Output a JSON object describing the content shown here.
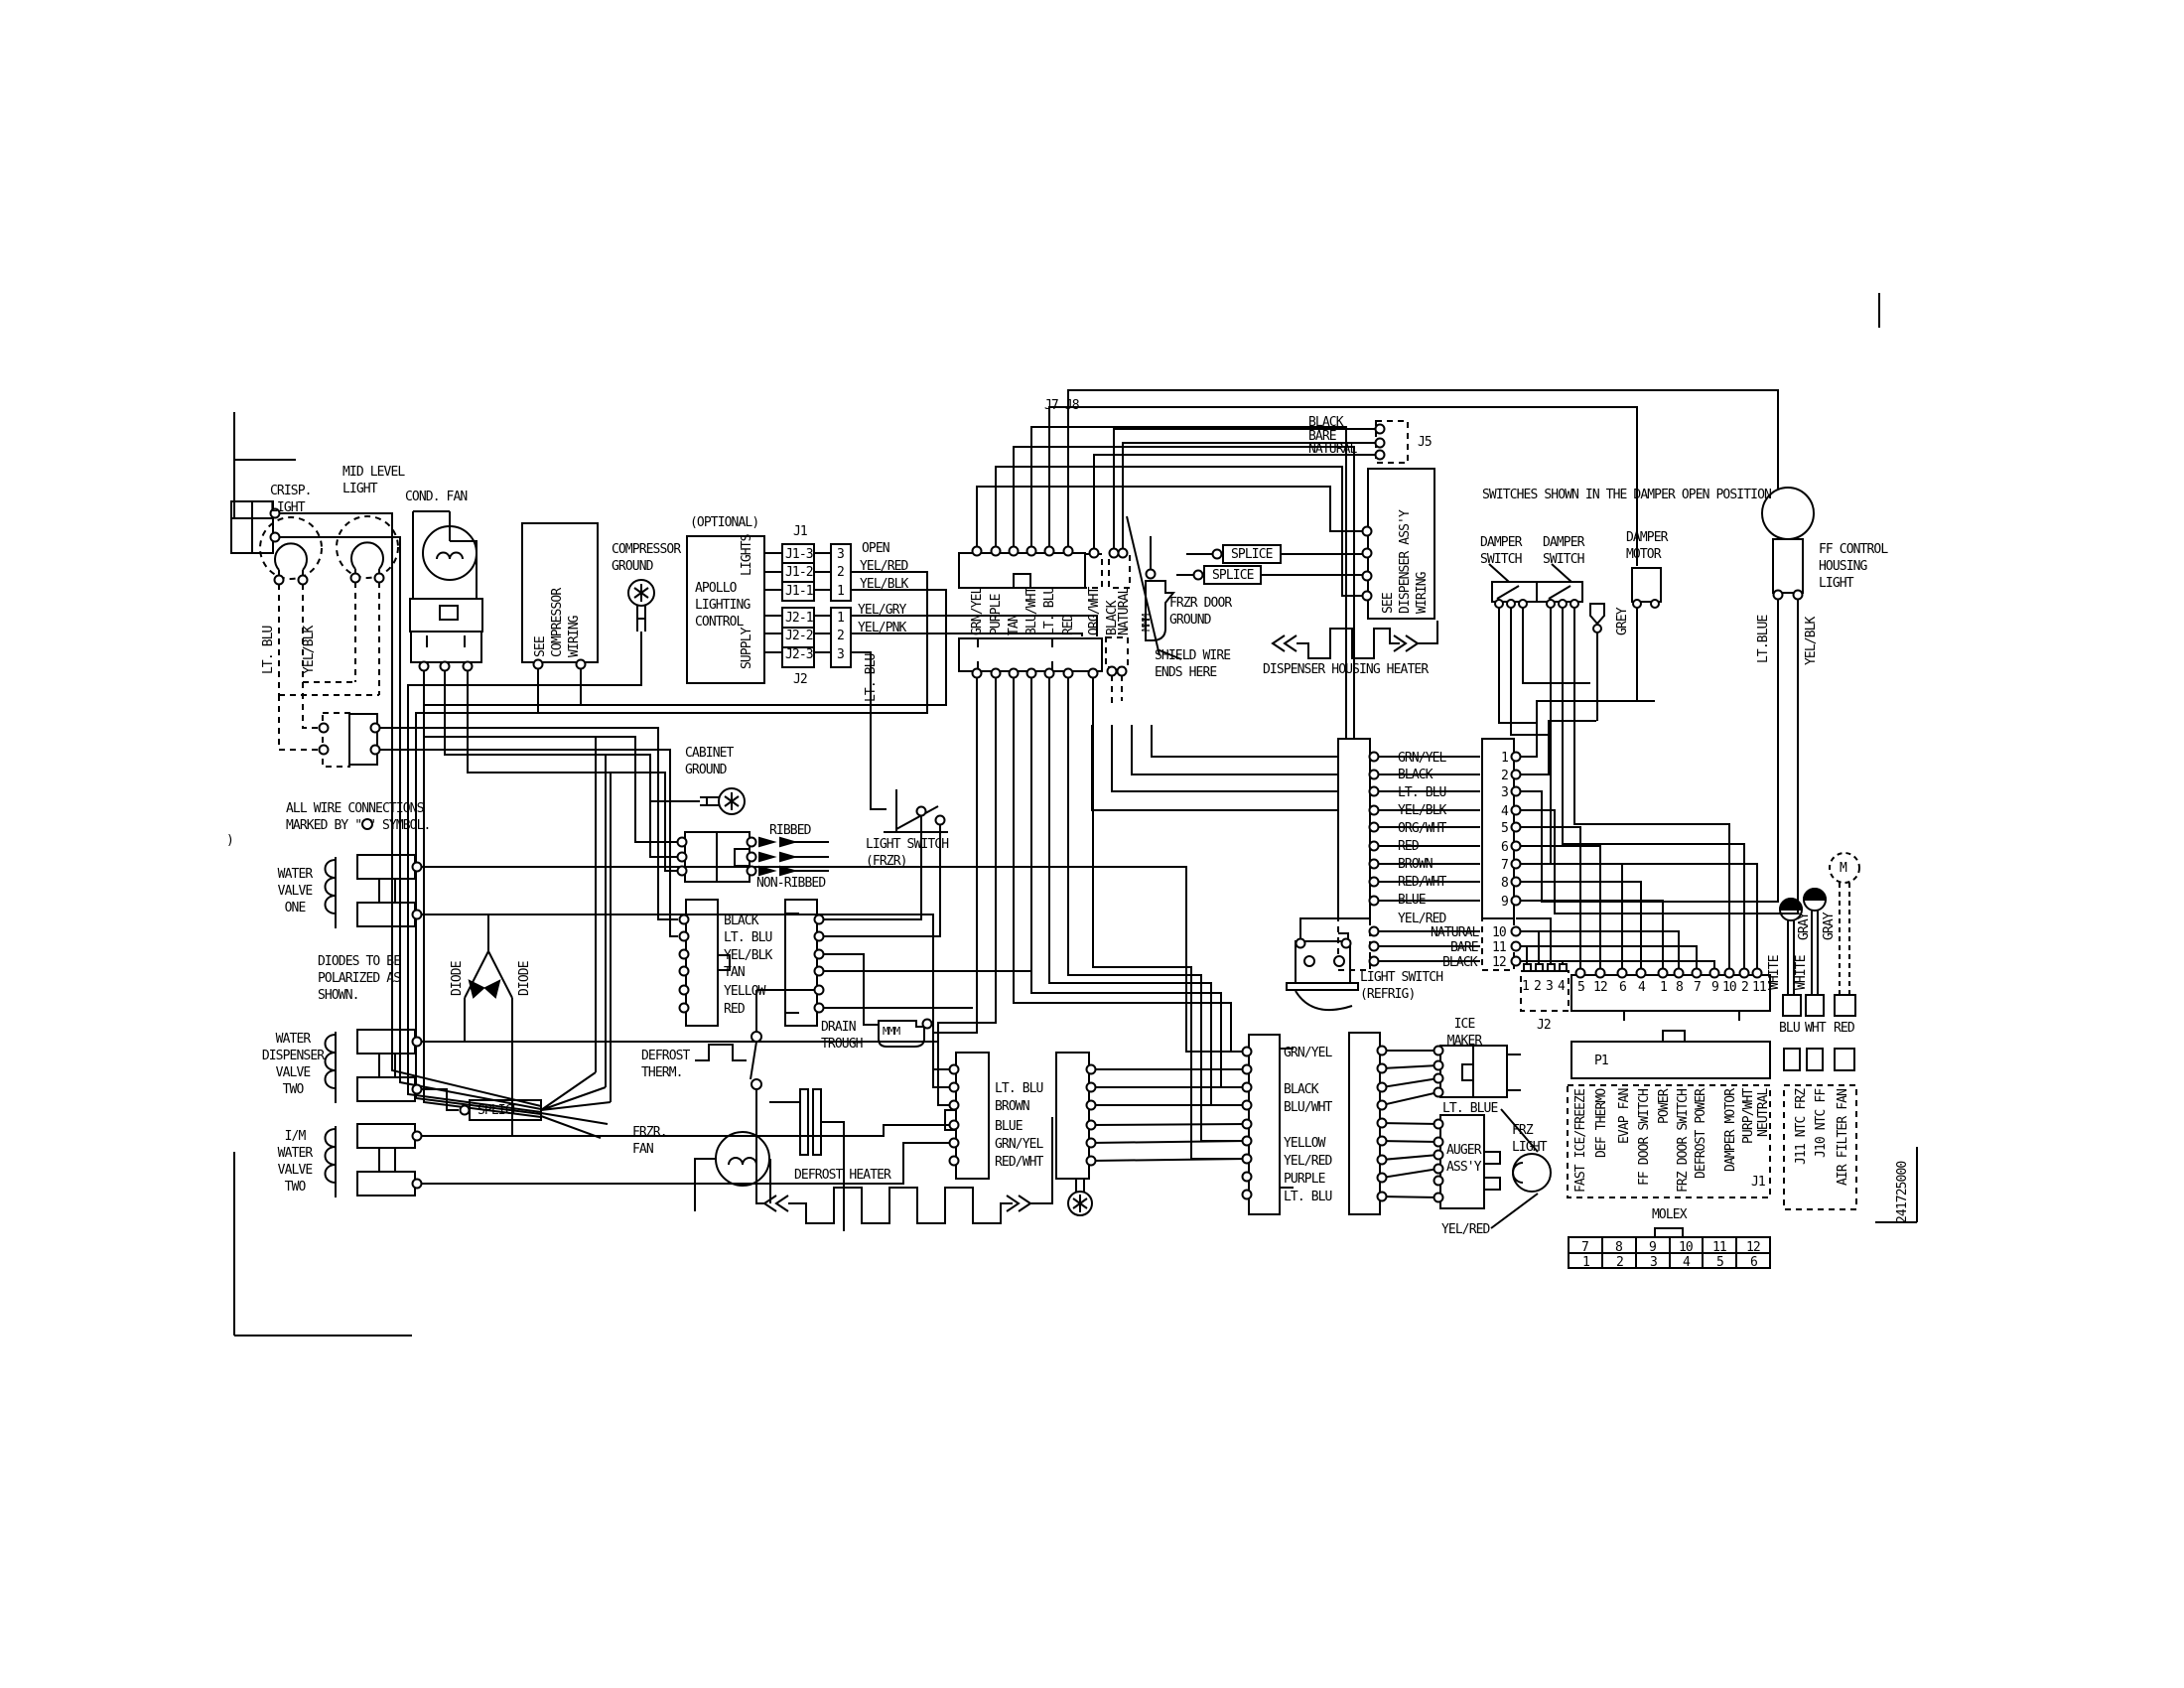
{
  "part_number": "241725000",
  "stray_mark": ")",
  "top_left": {
    "crisp_light": "CRISP.\nLIGHT",
    "mid_level_light": "MID LEVEL\nLIGHT",
    "cond_fan": "COND. FAN",
    "lt_blu": "LT. BLU",
    "yel_blk": "YEL/BLK",
    "see_compressor_wiring": "SEE\nCOMPRESSOR\nWIRING",
    "compressor_ground": "COMPRESSOR\nGROUND"
  },
  "apollo": {
    "optional": "(OPTIONAL)",
    "name": "APOLLO\nLIGHTING\nCONTROL",
    "lights": "LIGHTS",
    "supply": "SUPPLY",
    "j1": "J1",
    "j2": "J2",
    "j1_pins": [
      "J1-3",
      "J1-2",
      "J1-1"
    ],
    "j2_pins": [
      "J2-1",
      "J2-2",
      "J2-3"
    ],
    "conn_a_pins": [
      "3",
      "2",
      "1"
    ],
    "conn_b_pins": [
      "1",
      "2",
      "3"
    ],
    "open": "OPEN",
    "yel_red": "YEL/RED",
    "yel_blk": "YEL/BLK",
    "yel_gry": "YEL/GRY",
    "yel_pnk": "YEL/PNK",
    "lt_blu": "LT. BLU"
  },
  "door_harness": {
    "label": "J7 J8",
    "wires": [
      "GRN/YEL",
      "PURPLE",
      "TAN",
      "BLU/WHT",
      "LT. BLU",
      "RED",
      "ORG/WHT",
      "BLACK",
      "NATURAL"
    ]
  },
  "j5": {
    "label": "J5",
    "wires": [
      "BLACK",
      "BARE",
      "NATURAL"
    ]
  },
  "dispenser": {
    "assy": "SEE\nDISPENSER ASS'Y\nWIRING",
    "splice1": "SPLICE",
    "splice2": "SPLICE",
    "frzr_door_ground": "FRZR DOOR\nGROUND",
    "mmm": "MMM",
    "shield": "SHIELD WIRE\nENDS HERE",
    "heater": "DISPENSER HOUSING HEATER"
  },
  "damper": {
    "note": "SWITCHES SHOWN IN THE DAMPER OPEN POSITION",
    "switch1": "DAMPER\nSWITCH",
    "switch2": "DAMPER\nSWITCH",
    "motor": "DAMPER\nMOTOR",
    "grey": "GREY"
  },
  "ff_light": {
    "label": "FF CONTROL\nHOUSING\nLIGHT",
    "lt_blue": "LT.BLUE",
    "yel_blk": "YEL/BLK"
  },
  "main_connector": {
    "pin_numbers": [
      "1",
      "2",
      "3",
      "4",
      "5",
      "6",
      "7",
      "8",
      "9",
      "10",
      "11",
      "12"
    ],
    "wire_labels": [
      "GRN/YEL",
      "BLACK",
      "LT. BLU",
      "YEL/BLK",
      "ORG/WHT",
      "RED",
      "BROWN",
      "RED/WHT",
      "BLUE",
      "YEL/RED"
    ],
    "dashed_labels": [
      "NATURAL",
      "BARE",
      "BLACK"
    ]
  },
  "j2_conn": {
    "label": "J2",
    "pins": [
      "1",
      "2",
      "3",
      "4"
    ]
  },
  "harness": {
    "pins": [
      "5",
      "12",
      "6",
      "4",
      "1",
      "8",
      "7",
      "9",
      "10",
      "2",
      "11"
    ]
  },
  "switches": {
    "refrig": "LIGHT SWITCH\n(REFRIG)",
    "frzr": "LIGHT SWITCH\n(FRZR)"
  },
  "left_notes": {
    "wire_connections": "ALL WIRE CONNECTIONS\nMARKED BY \" \" SYMBOL.",
    "diodes": "DIODES TO BE\nPOLARIZED AS\nSHOWN.",
    "diode": "DIODE"
  },
  "valves": {
    "one": "WATER\nVALVE\nONE",
    "dispenser_two": "WATER\nDISPENSER\nVALVE\nTWO",
    "im_two": "I/M\nWATER\nVALVE\nTWO",
    "splice": "SPLICE"
  },
  "center": {
    "cabinet_ground": "CABINET\nGROUND",
    "ribbed": "RIBBED",
    "non_ribbed": "NON-RIBBED",
    "freezer_conn_wires": [
      "BLACK",
      "LT. BLU",
      "YEL/BLK",
      "TAN",
      "YELLOW",
      "RED"
    ],
    "drain_trough": "DRAIN\nTROUGH",
    "mmm": "MMM",
    "defrost_therm": "DEFROST\nTHERM.",
    "frzr_fan": "FRZR.\nFAN",
    "defrost_heater": "DEFROST HEATER"
  },
  "mid_connectors": {
    "left_wires": [
      "LT. BLU",
      "BROWN",
      "BLUE",
      "GRN/YEL",
      "RED/WHT"
    ],
    "right_wires": [
      "GRN/YEL",
      "BLACK",
      "BLU/WHT",
      "YELLOW",
      "YEL/RED",
      "PURPLE",
      "LT. BLU"
    ]
  },
  "ice": {
    "maker": "ICE\nMAKER",
    "lt_blue": "LT. BLUE",
    "auger": "AUGER\nASS'Y",
    "frz_light": "FRZ\nLIGHT",
    "yel_red": "YEL/RED"
  },
  "board": {
    "p1": "P1",
    "j1": "J1",
    "j1_signals": [
      "FAST ICE/FREEZE",
      "DEF THERMO",
      "EVAP FAN",
      "FF DOOR SWITCH",
      "POWER",
      "FRZ DOOR SWITCH",
      "DEFROST POWER",
      "DAMPER MOTOR",
      "PURP/WHT",
      "NEUTRAL"
    ],
    "sensor_signals": [
      "J11 NTC FRZ",
      "J10 NTC FF",
      "AIR FILTER FAN"
    ],
    "molex": "MOLEX",
    "molex_top": [
      "7",
      "8",
      "9",
      "10",
      "11",
      "12"
    ],
    "molex_bottom": [
      "1",
      "2",
      "3",
      "4",
      "5",
      "6"
    ],
    "plugs": [
      "BLU",
      "WHT",
      "RED"
    ],
    "white": "WHITE",
    "gray": "GRAY",
    "motor_m": "M"
  }
}
